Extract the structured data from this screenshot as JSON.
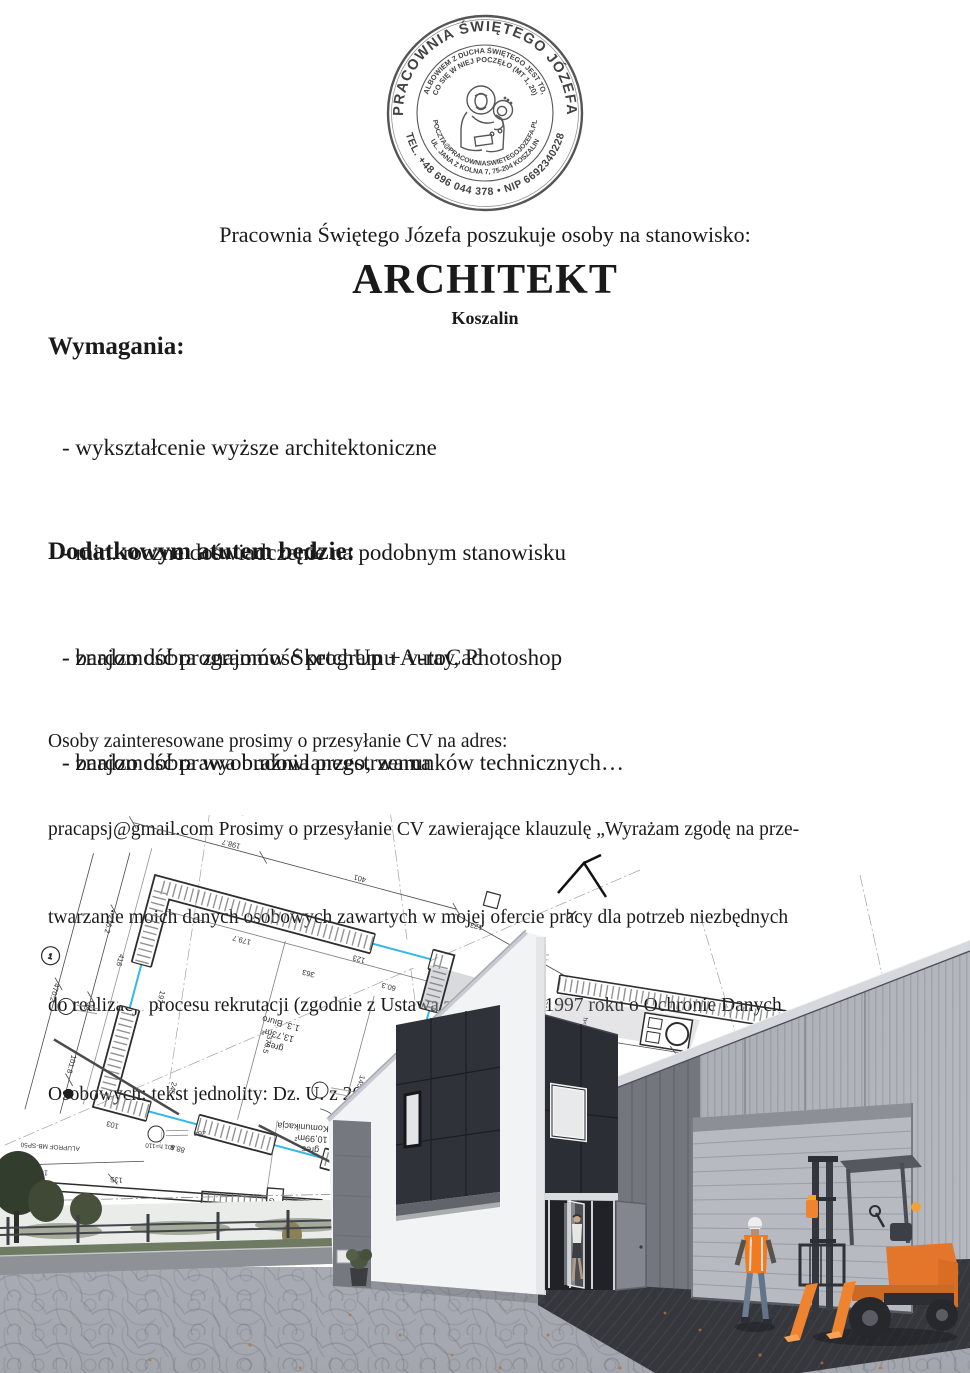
{
  "stamp": {
    "outer_top": "PRACOWNIA ŚWIĘTEGO JÓZEFA",
    "outer_bottom": "TEL. +48 696 044 378 • NIP 6692340228",
    "inner_top_1": "ALBOWIEM Z DUCHA ŚWIĘTEGO JEST TO,",
    "inner_top_2": "CO SIĘ W NIEJ POCZĘŁO (MT 1, 20)",
    "inner_bottom_outer": "UL. JANA Z KOLNA 7, 75-204 KOSZALIN",
    "inner_bottom_inner": "POCZTA@PRACOWNIASWIETEGOJOZEFA.PL",
    "ink_color": "#474747"
  },
  "header": {
    "intro": "Pracownia Świętego Józefa poszukuje osoby na stanowisko:",
    "position": "ARCHITEKT",
    "location": "Koszalin"
  },
  "requirements": {
    "heading": "Wymagania:",
    "items": [
      "- wykształcenie wyższe architektoniczne",
      "- min. roczne doświadczenie na podobnym stanowisku",
      "- bardzo dobra znajomość programu AutoCad",
      "- znajomość prawa budowlanego, warunków technicznych…"
    ]
  },
  "advantages": {
    "heading": "Dodatkowym atutem będzie:",
    "items": [
      "- znajomość programów SketchUp + v-ray, Photoshop",
      "- bardzo dobra wyobraźnia przestrzenna"
    ]
  },
  "contact": {
    "lines": [
      "Osoby zainteresowane prosimy o przesyłanie CV na adres:",
      "pracapsj@gmail.com Prosimy o przesyłanie CV zawierające klauzulę „Wyrażam zgodę na prze-",
      "twarzanie moich danych osobowych zawartych w mojej ofercie pracy dla potrzeb niezbędnych",
      "do realizacji procesu rekrutacji (zgodnie z Ustawą z dnia 29.08.1997 roku o Ochronie Danych",
      "Osobowych: tekst jednolity: Dz. U. z 2002r Nr 101, poz. 926 ze zm.)"
    ]
  },
  "illustration": {
    "accent_color": "#35b8e8",
    "dim_labels": [
      "198.7",
      "401",
      "123",
      "79.3",
      "179.7",
      "363",
      "60.3",
      "123",
      "216.2",
      "98",
      "101.8",
      "470.2",
      "416",
      "197.2",
      "376.5",
      "245",
      "145",
      "103",
      "88.8",
      "416",
      "82.9",
      "109.6",
      "24",
      "244.5",
      "62",
      "88",
      "h=241,5",
      "sufit podwiesz.",
      "135",
      "124",
      "151",
      "24",
      "564.1",
      "19.5",
      "34",
      "264",
      "401 h=110",
      "149.3",
      "ALUPROF MB-SP50",
      "12",
      "39"
    ],
    "room_a": [
      "1.3. Biuro",
      "13,73m²",
      "gres"
    ],
    "room_b": [
      "1.2. Komunikacja",
      "10,99m²",
      "gres"
    ],
    "markers": {
      "axis_1": "1",
      "gate": "G",
      "section": "A"
    }
  }
}
